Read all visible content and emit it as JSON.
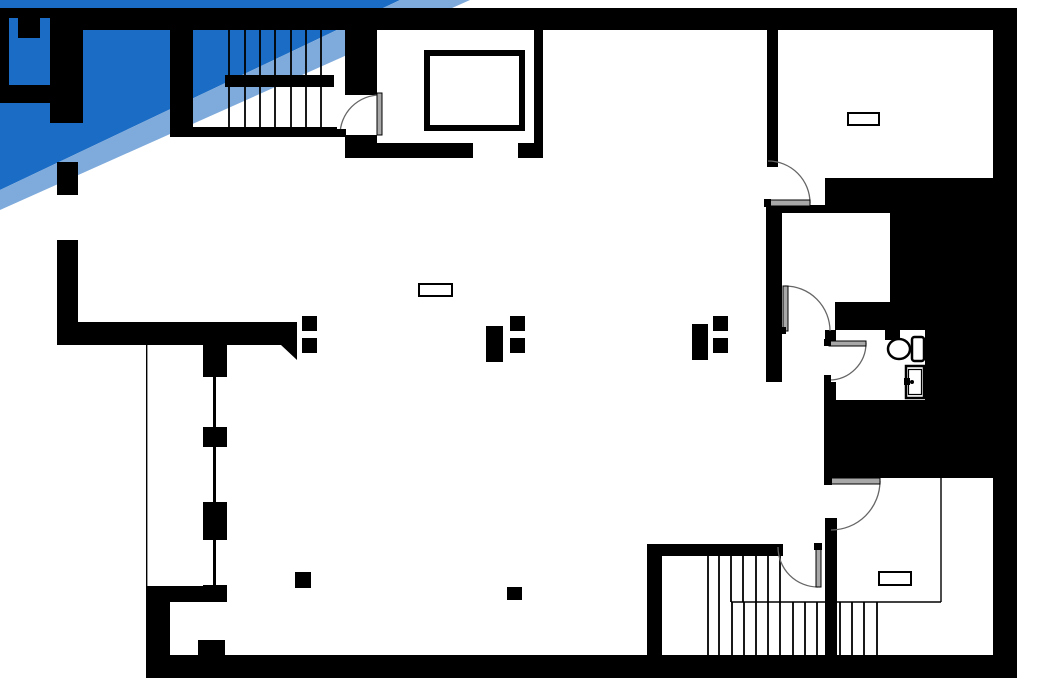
{
  "page": {
    "name": "architectural-floor-plan",
    "width_px": 1058,
    "height_px": 686,
    "visible_text": ""
  },
  "colors": {
    "wall": "#000000",
    "banner_dark": "#1b6cc4",
    "banner_light": "#7fabdc",
    "white": "#ffffff",
    "leaf": "#a8a8a8",
    "arc": "#666666"
  },
  "banner": {
    "style": "double-diagonal-ribbon",
    "position": "top-left",
    "bands": [
      "dark-blue",
      "light-blue"
    ]
  },
  "plan": {
    "staircases": [
      {
        "location": "top-left",
        "tread_lines": 7,
        "landing_bar": true
      },
      {
        "location": "bottom-right",
        "upper_tread_lines": 7,
        "lower_tread_lines": 12,
        "side_tread_lines": 4
      }
    ],
    "elevator": {
      "present": true,
      "cab_outline": true,
      "location": "top-center"
    },
    "bathroom": {
      "toilet": true,
      "sink": true,
      "location": "middle-right"
    },
    "door_swings": 6,
    "ceiling_light_symbols": 3,
    "window_bays_left_wall": 3,
    "column_blocks": 10
  }
}
